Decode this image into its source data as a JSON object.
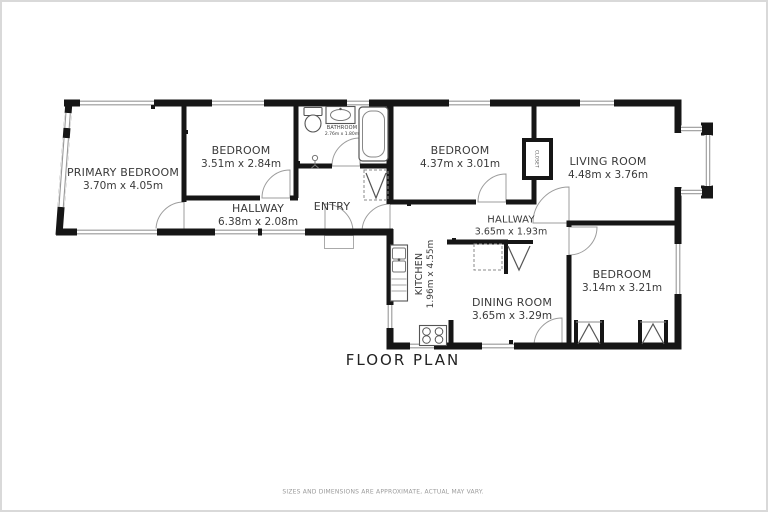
{
  "title": "FLOOR PLAN",
  "footnote": "SIZES AND DIMENSIONS ARE APPROXIMATE, ACTUAL MAY VARY.",
  "rooms": {
    "primary_bedroom": {
      "name": "PRIMARY BEDROOM",
      "dims": "3.70m x 4.05m"
    },
    "bedroom2": {
      "name": "BEDROOM",
      "dims": "3.51m x 2.84m"
    },
    "hallway_west": {
      "name": "HALLWAY",
      "dims": "6.38m x 2.08m"
    },
    "bathroom": {
      "name": "BATHROOM",
      "dims": "2.76m x 1.80m"
    },
    "entry": {
      "name": "ENTRY",
      "dims": ""
    },
    "bedroom3": {
      "name": "BEDROOM",
      "dims": "4.37m x 3.01m"
    },
    "closet": {
      "name": "CLOSET",
      "dims": ""
    },
    "living_room": {
      "name": "LIVING ROOM",
      "dims": "4.48m x 3.76m"
    },
    "hallway_east": {
      "name": "HALLWAY",
      "dims": "3.65m x 1.93m"
    },
    "kitchen": {
      "name": "KITCHEN",
      "dims": "1.96m x 4.55m"
    },
    "dining_room": {
      "name": "DINING ROOM",
      "dims": "3.65m x 3.29m"
    },
    "bedroom4": {
      "name": "BEDROOM",
      "dims": "3.14m x 3.21m"
    }
  },
  "colors": {
    "wall": "#161616",
    "text": "#3a3a3a",
    "window_frame": "#999999",
    "door_arc": "#9c9c9c",
    "footnote": "#9a9a9a"
  }
}
